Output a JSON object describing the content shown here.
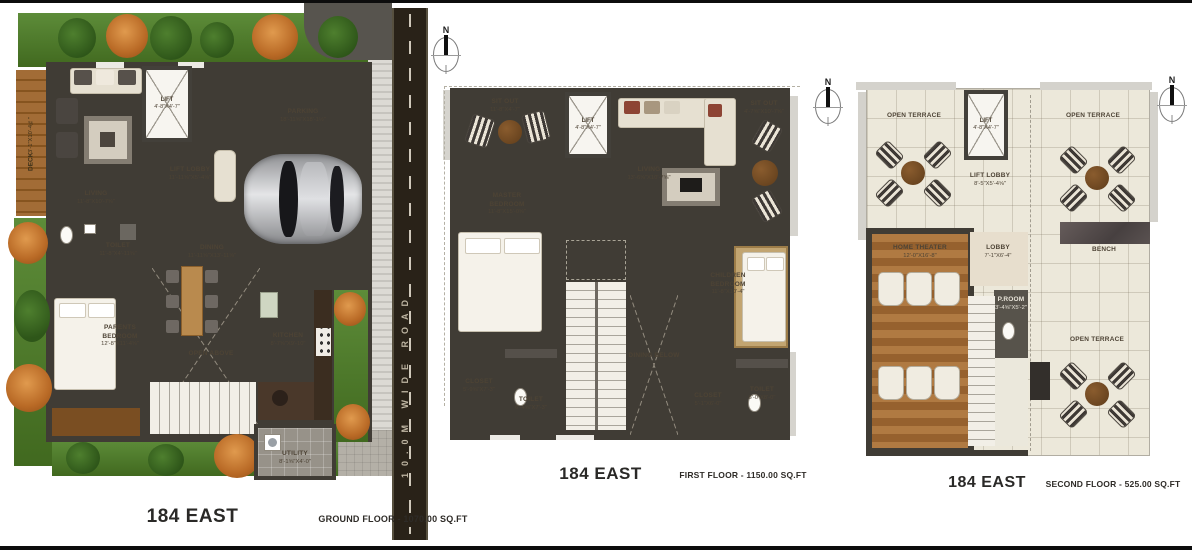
{
  "compass": {
    "label": "N"
  },
  "palette": {
    "wall": "#403c35",
    "floor": "#e8dfcd",
    "wood": "#b07a42",
    "road": "#292218",
    "hedge": "#4f7c2e",
    "terrace": "#ece8da"
  },
  "ground": {
    "title": "184 EAST",
    "floor_label": "GROUND FLOOR - 1070.00 SQ.FT",
    "road_label": "10.0M WIDE ROAD",
    "rooms": {
      "deck": {
        "name": "DECK",
        "dims": "3'-1\"X10'-4⅝\""
      },
      "living": {
        "name": "LIVING",
        "dims": "11'-8\"X10'-7⅝\""
      },
      "lift": {
        "name": "LIFT",
        "dims": "4'-8\"X4'-7\""
      },
      "lift_lobby": {
        "name": "LIFT LOBBY",
        "dims": "11'-11⅝\"X5'-4⅝\""
      },
      "parking": {
        "name": "PARKING",
        "dims": "18'-11⅝\"X18'-1½\""
      },
      "toilet": {
        "name": "TOILET",
        "dims": "11'-8\"X4'-11⅝\""
      },
      "dining": {
        "name": "DINING",
        "dims": "11'-11⅝\"X13'-11⅝\""
      },
      "parents_bedroom": {
        "name": "PARENTS BEDROOM",
        "dims": "12'-8\"X11'-4⅝\""
      },
      "open_above": {
        "name": "OPEN ABOVE",
        "dims": ""
      },
      "kitchen": {
        "name": "KITCHEN",
        "dims": "8'-7⅝\"X9'-10\""
      },
      "utility": {
        "name": "UTILITY",
        "dims": "8'-1⅝\"X4'-0\""
      }
    }
  },
  "first": {
    "title": "184 EAST",
    "floor_label": "FIRST FLOOR - 1150.00 SQ.FT",
    "rooms": {
      "sit_out_left": {
        "name": "SIT OUT",
        "dims": "11'-8\"X4'-7\""
      },
      "lift": {
        "name": "LIFT",
        "dims": "4'-8\"X4'-7\""
      },
      "living": {
        "name": "LIVING",
        "dims": "13'-6⅝\"X10'-7⅝\""
      },
      "sit_out_right": {
        "name": "SIT OUT",
        "dims": "4'-7⅝\"X10'-7⅝\""
      },
      "master_bedroom": {
        "name": "MASTER BEDROOM",
        "dims": "11'-8\"X15'-0⅝\""
      },
      "children_bedroom": {
        "name": "CHILDREN BEDROOM",
        "dims": "11'-8\"X10'-4\""
      },
      "dining_below": {
        "name": "DINING BELOW",
        "dims": ""
      },
      "closet_left": {
        "name": "CLOSET",
        "dims": "5'-9⅝\"X7'-3\""
      },
      "toilet_left": {
        "name": "TOILET",
        "dims": "6'-4⅝\"X7'-3\""
      },
      "closet_right": {
        "name": "CLOSET",
        "dims": "5'-1\"X6'-0\""
      },
      "toilet_right": {
        "name": "TOILET",
        "dims": "6'-0\"X8'-0\""
      }
    }
  },
  "second": {
    "title": "184 EAST",
    "floor_label": "SECOND FLOOR - 525.00 SQ.FT",
    "rooms": {
      "open_terrace_left": {
        "name": "OPEN TERRACE",
        "dims": ""
      },
      "lift": {
        "name": "LIFT",
        "dims": "4'-8\"X4'-7\""
      },
      "lift_lobby": {
        "name": "LIFT LOBBY",
        "dims": "8'-5\"X5'-4⅝\""
      },
      "open_terrace_right": {
        "name": "OPEN TERRACE",
        "dims": ""
      },
      "bench": {
        "name": "BENCH",
        "dims": ""
      },
      "home_theater": {
        "name": "HOME THEATER",
        "dims": "12'-0\"X16'-8\""
      },
      "lobby": {
        "name": "LOBBY",
        "dims": "7'-1\"X6'-4\""
      },
      "p_room": {
        "name": "P.ROOM",
        "dims": "3'-4⅝\"X5'-2\""
      },
      "open_terrace_bottom": {
        "name": "OPEN TERRACE",
        "dims": ""
      }
    }
  }
}
